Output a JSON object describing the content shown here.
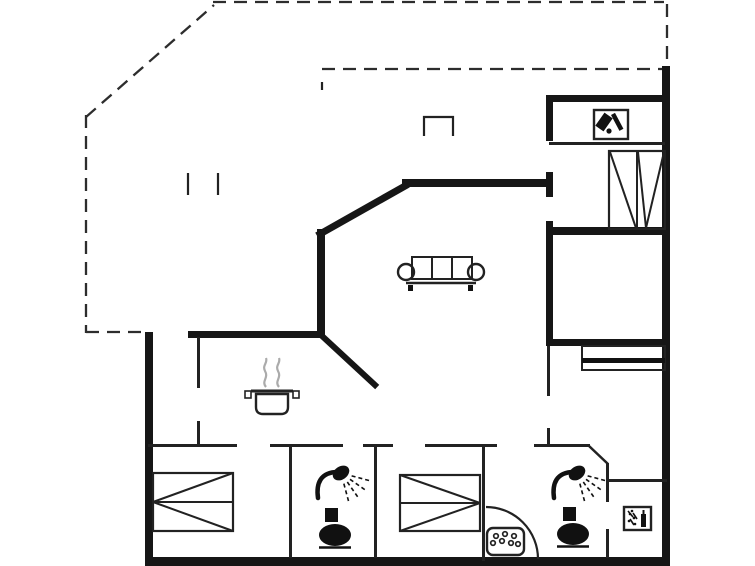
{
  "canvas": {
    "width": 755,
    "height": 566,
    "background": "#ffffff"
  },
  "colors": {
    "wall": "#161616",
    "thin": "#222222",
    "dashed": "#2d2d2d",
    "steam": "#ababab",
    "fill": "#111111"
  },
  "floorplan": {
    "walls_thick": [
      [
        145,
        332,
        8,
        233,
        "left-exterior-wall"
      ],
      [
        145,
        557,
        525,
        9,
        "bottom-exterior-wall"
      ],
      [
        662,
        66,
        8,
        500,
        "right-exterior-wall"
      ],
      [
        546,
        95,
        124,
        7,
        "north-room-top-wall"
      ],
      [
        546,
        227,
        124,
        8,
        "north-room-bottom-wall"
      ],
      [
        402,
        179,
        151,
        8,
        "living-room-north-wall"
      ],
      [
        317,
        229,
        8,
        108,
        "living-room-west-wall"
      ],
      [
        188,
        331,
        137,
        7,
        "kitchen-north-wall"
      ],
      [
        546,
        339,
        124,
        7,
        "east-wing-divider-wall"
      ],
      [
        546,
        95,
        7,
        46,
        "central-wall-upper"
      ],
      [
        546,
        172,
        7,
        25,
        "central-wall-middle"
      ],
      [
        546,
        221,
        7,
        120,
        "central-wall-lower"
      ]
    ],
    "diagonals_thick": [
      [
        320,
        234,
        405,
        186,
        7,
        "living-room-diagonal-wall"
      ],
      [
        322,
        336,
        375,
        385,
        6,
        "kitchen-diagonal-wall"
      ]
    ],
    "walls_thin": [
      [
        197,
        337,
        3,
        51,
        "entry-kitchen-divider-upper"
      ],
      [
        197,
        421,
        3,
        25,
        "entry-kitchen-divider-lower"
      ],
      [
        148,
        444,
        89,
        3,
        "corridor-wall-a"
      ],
      [
        270,
        444,
        73,
        3,
        "corridor-wall-b"
      ],
      [
        363,
        444,
        30,
        3,
        "corridor-wall-c"
      ],
      [
        425,
        444,
        72,
        3,
        "corridor-wall-d"
      ],
      [
        534,
        444,
        56,
        3,
        "corridor-wall-e"
      ],
      [
        289,
        446,
        3,
        112,
        "bedroom1-showerroom-wall"
      ],
      [
        374,
        446,
        3,
        112,
        "showerroom-bedroom2-wall"
      ],
      [
        482,
        446,
        3,
        115,
        "bedroom2-bathroom-wall"
      ],
      [
        606,
        463,
        3,
        39,
        "bathroom-utility-wall-upper"
      ],
      [
        606,
        529,
        3,
        29,
        "bathroom-utility-wall-lower"
      ],
      [
        607,
        479,
        60,
        3,
        "utility-room-top-wall"
      ],
      [
        547,
        346,
        3,
        50,
        "east-room-wall-upper"
      ],
      [
        547,
        428,
        3,
        18,
        "east-room-wall-lower"
      ],
      [
        549,
        142,
        116,
        3,
        "north-room-shelf-line"
      ]
    ],
    "diagonals_thin": [
      [
        589,
        446,
        608,
        464,
        2.5,
        "bathroom-chamfer-wall"
      ]
    ],
    "dashed_lines": [
      [
        86,
        115,
        86,
        333,
        "terrace-west-dashed"
      ],
      [
        86,
        332,
        147,
        332,
        "terrace-south-dashed"
      ],
      [
        86,
        117,
        214,
        5,
        "terrace-diagonal-dashed"
      ],
      [
        213,
        2,
        664,
        2,
        "roof-north-dashed"
      ],
      [
        667,
        4,
        667,
        68,
        "roof-east-dashed"
      ],
      [
        322,
        69,
        664,
        69,
        "roof-overhang-dashed"
      ]
    ],
    "ticks": [
      [
        188,
        173,
        188,
        195,
        "terrace-post-mark-1"
      ],
      [
        218,
        173,
        218,
        195,
        "terrace-post-mark-2"
      ],
      [
        322,
        82,
        322,
        90,
        "overhang-end-mark"
      ]
    ],
    "open_rect": {
      "x": 424,
      "y": 117,
      "w": 29,
      "h": 19,
      "name": "porch-step-mark"
    },
    "door_arc": {
      "x1": 486,
      "y1": 507,
      "r": 52,
      "x2": 538,
      "y2": 559,
      "name": "bathroom-door-swing"
    },
    "furniture": {
      "sofa": {
        "x": 398,
        "y": 255,
        "name": "sofa"
      },
      "pot": {
        "x": 245,
        "y": 352,
        "name": "cooking-pot"
      },
      "beds": [
        {
          "x": 153,
          "y": 473,
          "w": 80,
          "h": 58,
          "apex": "left",
          "name": "double-bed-1"
        },
        {
          "x": 400,
          "y": 475,
          "w": 80,
          "h": 56,
          "apex": "right",
          "name": "double-bed-2"
        }
      ],
      "wardrobe": {
        "x": 609,
        "y": 151,
        "w": 56,
        "h": 78,
        "divider": 637,
        "name": "wardrobe"
      },
      "sideboard": {
        "x": 582,
        "y": 346,
        "w": 83,
        "h": 24,
        "band_y": 358,
        "band_h": 5,
        "name": "sideboard"
      },
      "showers": [
        {
          "x": 314,
          "y": 462,
          "name": "shower-1"
        },
        {
          "x": 550,
          "y": 462,
          "name": "shower-2"
        }
      ],
      "toilets": [
        {
          "x": 318,
          "y": 508,
          "name": "toilet-1"
        },
        {
          "x": 556,
          "y": 507,
          "name": "toilet-2"
        }
      ],
      "dotted_tray": {
        "x": 487,
        "y": 528,
        "w": 37,
        "h": 27,
        "dots": [
          [
            9,
            8
          ],
          [
            18,
            6
          ],
          [
            27,
            8
          ],
          [
            6,
            15
          ],
          [
            15,
            13
          ],
          [
            24,
            15
          ],
          [
            31,
            16
          ]
        ],
        "name": "pebble-tray"
      },
      "icon_boxes": [
        {
          "x": 594,
          "y": 110,
          "w": 34,
          "h": 29,
          "variant": "bottles",
          "name": "cleaning-cupboard-icon"
        },
        {
          "x": 624,
          "y": 507,
          "w": 27,
          "h": 23,
          "variant": "sprinkle",
          "name": "utility-appliance-icon"
        }
      ]
    }
  }
}
